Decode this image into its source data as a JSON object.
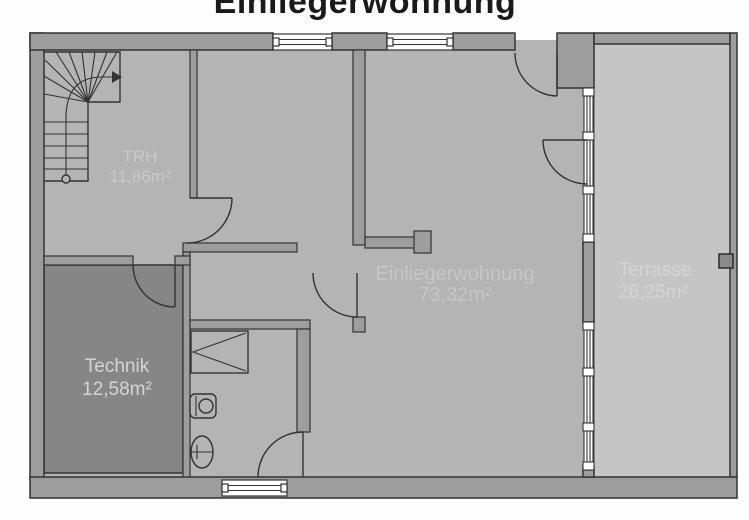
{
  "title": "Einliegerwohnung",
  "rooms": [
    {
      "key": "trh",
      "label": "TRH",
      "area": "11,86m²"
    },
    {
      "key": "technik",
      "label": "Technik",
      "area": "12,58m²"
    },
    {
      "key": "einliegerwohnung",
      "label": "Einliegerwohnung",
      "area": "73,32m²"
    },
    {
      "key": "terrasse",
      "label": "Terrasse",
      "area": "26,25m²"
    }
  ],
  "icons": {
    "staircase": "winder-stair-with-direction-arrow",
    "fixtures": [
      "shower-symbol",
      "washbasin-symbol",
      "wc-symbol"
    ],
    "doors": [
      "entry-door-swing",
      "terrace-door-swing",
      "trh-door-swing",
      "technik-door-swing",
      "corridor-door-swing",
      "bathroom-door-swing"
    ]
  },
  "colors": {
    "wall": "#9d9d9d",
    "floor": "#b4b4b4",
    "floor_technik": "#868686",
    "floor_terrace": "#c5c5c5",
    "outline": "#333333",
    "room_label": "#c9c9c9",
    "title": "#1a1a1a",
    "window": "#ffffff"
  }
}
